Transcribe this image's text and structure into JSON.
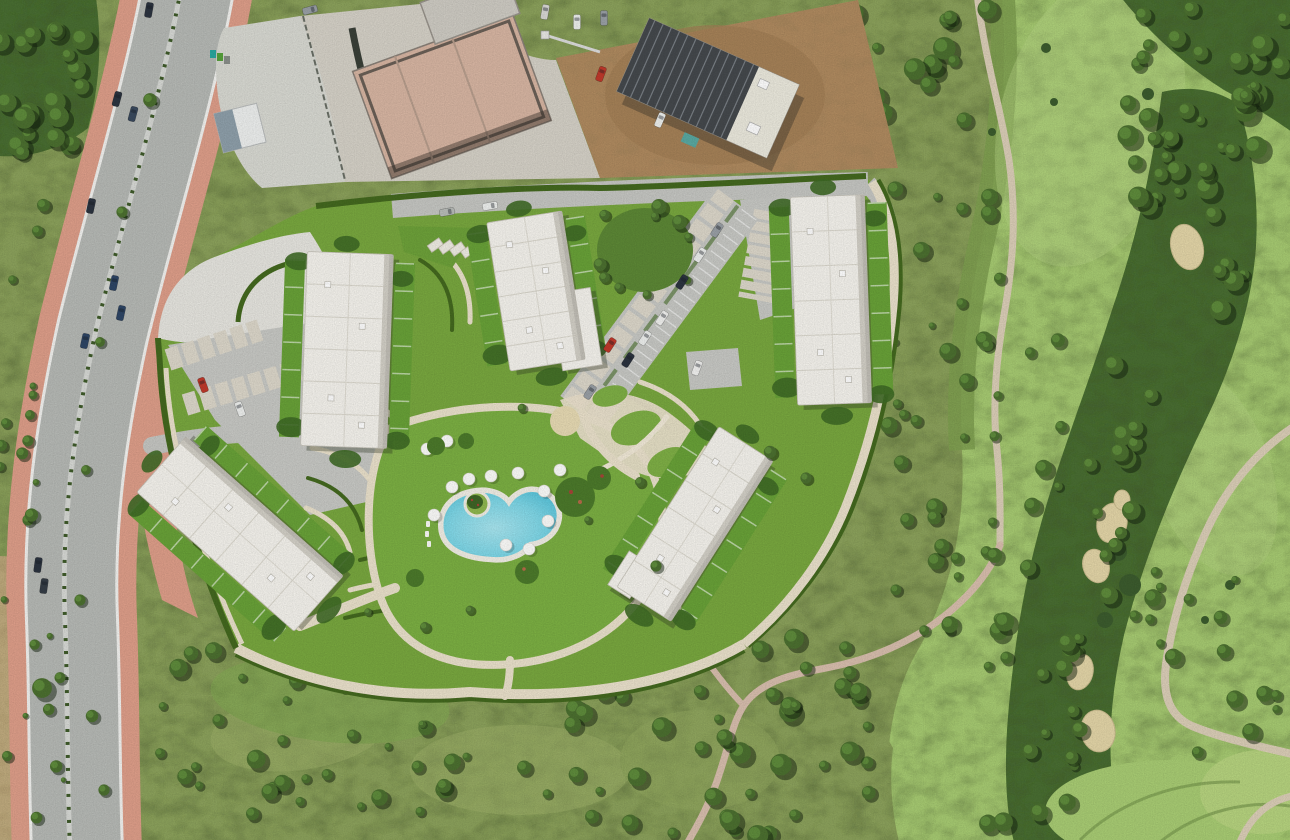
{
  "scene": {
    "description": "Aerial satellite view of a gated resort-style residential development with five white flat-roofed apartment buildings around landscaped gardens and a freeform swimming pool, bordered by a curved coastal avenue on the west, an active construction site to the north, and a golf course with fairways, tree lines and sand bunkers to the east",
    "features": [
      "curved-avenue-with-pink-sidewalks",
      "construction-site",
      "five-apartment-buildings",
      "swimming-pool-with-parasols",
      "terraced-hedge-gardens",
      "carport-parking",
      "golf-fairway",
      "sand-bunkers",
      "cart-paths",
      "scrubland"
    ]
  },
  "palette": {
    "scrub": "#8ca25c",
    "dry_scrub": "#c0ab7e",
    "fairway": "#a7cb72",
    "rough": "#7fa050",
    "trees": "#4a6e33",
    "lawn": "#79a83f",
    "pool_lawn": "#7cb043",
    "hedge": "#44691f",
    "asphalt": "#b7bab6",
    "sidewalk": "#df9f8a",
    "curb": "#f3f3f0",
    "gravel": "#d9dad3",
    "white_gravel": "#e7e6e0",
    "dirt": "#b08b60",
    "concrete_slab": "#d8b6a3",
    "dark_roof": "#45494d",
    "parking": "#c8c9c5",
    "carport": "#ddd8cb",
    "building": "#f6f4ee",
    "building_edge": "#cfccc2",
    "roof_line": "#dcd9cf",
    "path_cream": "#ebe2cc",
    "plaza_sand": "#e8dbb4",
    "pool_deck": "#f2efe6",
    "pool_water": "#6fd2e4",
    "bunker": "#e4d6a8",
    "cart_path": "#dccfb8",
    "trail": "#d9bfae",
    "shadow": "rgba(45,55,35,0.35)"
  },
  "buildings": [
    {
      "id": 1,
      "cx": 347,
      "cy": 350,
      "w": 86,
      "h": 194,
      "rot": 2
    },
    {
      "id": 2,
      "cx": 536,
      "cy": 291,
      "w": 76,
      "h": 150,
      "rot": -9,
      "annex": {
        "dx": 34,
        "dy": 44,
        "w": 40,
        "h": 78
      }
    },
    {
      "id": 3,
      "cx": 831,
      "cy": 300,
      "w": 74,
      "h": 208,
      "rot": -2
    },
    {
      "id": 4,
      "cx": 695,
      "cy": 524,
      "w": 64,
      "h": 190,
      "rot": 32.5,
      "annex": {
        "dx": -28,
        "dy": 78,
        "w": 26,
        "h": 40
      }
    },
    {
      "id": 5,
      "cx": 240,
      "cy": 534,
      "w": 74,
      "h": 210,
      "rot": -48.5
    }
  ],
  "parasols": [
    [
      452,
      487
    ],
    [
      469,
      479
    ],
    [
      491,
      476
    ],
    [
      518,
      473
    ],
    [
      544,
      491
    ],
    [
      548,
      521
    ],
    [
      434,
      515
    ],
    [
      506,
      545
    ],
    [
      529,
      549
    ],
    [
      427,
      449
    ],
    [
      447,
      441
    ],
    [
      560,
      470
    ]
  ],
  "flower_beds": [
    [
      575,
      497,
      20
    ],
    [
      599,
      478,
      12
    ],
    [
      527,
      572,
      12
    ],
    [
      436,
      446,
      9
    ],
    [
      466,
      441,
      8
    ],
    [
      415,
      578,
      9
    ]
  ],
  "cars": {
    "road": [
      {
        "x": 149,
        "y": 10,
        "a": 10,
        "c": "#2c3440"
      },
      {
        "x": 310,
        "y": 10,
        "a": 75,
        "c": "#9aa0a6"
      },
      {
        "x": 313,
        "y": 30,
        "a": 80,
        "c": "#eef0ee"
      },
      {
        "x": 117,
        "y": 99,
        "a": 15,
        "c": "#2c3440"
      },
      {
        "x": 133,
        "y": 114,
        "a": 15,
        "c": "#3a4a5e"
      },
      {
        "x": 91,
        "y": 206,
        "a": 12,
        "c": "#2c3440"
      },
      {
        "x": 114,
        "y": 283,
        "a": 12,
        "c": "#2e4666"
      },
      {
        "x": 121,
        "y": 313,
        "a": 12,
        "c": "#2e4666"
      },
      {
        "x": 85,
        "y": 341,
        "a": 12,
        "c": "#2e4666"
      },
      {
        "x": 38,
        "y": 565,
        "a": 8,
        "c": "#2c3440"
      },
      {
        "x": 44,
        "y": 586,
        "a": 8,
        "c": "#353d46"
      }
    ],
    "development": [
      {
        "x": 203,
        "y": 385,
        "a": -20,
        "c": "#c0392b"
      },
      {
        "x": 240,
        "y": 409,
        "a": -20,
        "c": "#eef0ee"
      },
      {
        "x": 610,
        "y": 345,
        "a": 33,
        "c": "#c0392b"
      },
      {
        "x": 645,
        "y": 338,
        "a": 33,
        "c": "#eef0ee"
      },
      {
        "x": 628,
        "y": 360,
        "a": 33,
        "c": "#2c3440"
      },
      {
        "x": 662,
        "y": 318,
        "a": 33,
        "c": "#f2f2f0"
      },
      {
        "x": 697,
        "y": 368,
        "a": 20,
        "c": "#f2f2f0"
      },
      {
        "x": 590,
        "y": 392,
        "a": 33,
        "c": "#9aa0a6"
      },
      {
        "x": 717,
        "y": 230,
        "a": 33,
        "c": "#9aa0a6"
      },
      {
        "x": 700,
        "y": 255,
        "a": 33,
        "c": "#eef0ee"
      },
      {
        "x": 682,
        "y": 282,
        "a": 33,
        "c": "#2c3440"
      },
      {
        "x": 447,
        "y": 212,
        "a": 80,
        "c": "#b9bdb9"
      },
      {
        "x": 490,
        "y": 206,
        "a": 80,
        "c": "#eef0ee"
      }
    ],
    "construction": [
      {
        "x": 601,
        "y": 74,
        "a": 20,
        "c": "#c0392b"
      },
      {
        "x": 577,
        "y": 22,
        "a": 0,
        "c": "#eef0ee"
      },
      {
        "x": 604,
        "y": 18,
        "a": 0,
        "c": "#9aa0a6"
      },
      {
        "x": 660,
        "y": 120,
        "a": 23,
        "c": "#eef0ee"
      },
      {
        "x": 545,
        "y": 12,
        "a": 10,
        "c": "#d8d8d4"
      }
    ]
  },
  "vegetation": {
    "tree_regions": [
      {
        "x": 160,
        "y": 640,
        "w": 470,
        "h": 190,
        "n": 55,
        "min": 0.6,
        "max": 1.6,
        "seed": 7,
        "layer": "low"
      },
      {
        "x": 630,
        "y": 636,
        "w": 240,
        "h": 200,
        "n": 26,
        "min": 0.7,
        "max": 1.8,
        "seed": 11,
        "layer": "low"
      },
      {
        "x": 882,
        "y": 175,
        "w": 118,
        "h": 460,
        "n": 38,
        "min": 0.5,
        "max": 1.4,
        "seed": 5,
        "layer": "low"
      },
      {
        "x": 0,
        "y": 0,
        "w": 102,
        "h": 162,
        "n": 20,
        "min": 0.8,
        "max": 1.8,
        "seed": 3,
        "layer": "low"
      },
      {
        "x": 0,
        "y": 168,
        "w": 52,
        "h": 390,
        "n": 12,
        "min": 0.5,
        "max": 1.1,
        "seed": 9,
        "layer": "low"
      },
      {
        "x": 853,
        "y": 0,
        "w": 140,
        "h": 122,
        "n": 15,
        "min": 0.8,
        "max": 1.9,
        "seed": 13,
        "layer": "low"
      },
      {
        "x": 1128,
        "y": 0,
        "w": 162,
        "h": 168,
        "n": 26,
        "min": 0.8,
        "max": 2.0,
        "seed": 19,
        "layer": "low"
      },
      {
        "x": 1138,
        "y": 84,
        "w": 118,
        "h": 250,
        "n": 22,
        "min": 0.8,
        "max": 1.8,
        "seed": 17,
        "layer": "low"
      },
      {
        "x": 1028,
        "y": 340,
        "w": 132,
        "h": 290,
        "n": 24,
        "min": 0.7,
        "max": 1.7,
        "seed": 21,
        "layer": "low"
      },
      {
        "x": 988,
        "y": 618,
        "w": 108,
        "h": 215,
        "n": 20,
        "min": 0.7,
        "max": 1.6,
        "seed": 23,
        "layer": "low"
      },
      {
        "x": 1150,
        "y": 560,
        "w": 140,
        "h": 200,
        "n": 14,
        "min": 0.6,
        "max": 1.4,
        "seed": 27,
        "layer": "low"
      },
      {
        "x": 700,
        "y": 640,
        "w": 170,
        "h": 110,
        "n": 13,
        "min": 0.6,
        "max": 1.5,
        "seed": 29,
        "layer": "low"
      },
      {
        "x": 4,
        "y": 560,
        "w": 60,
        "h": 270,
        "n": 10,
        "min": 0.4,
        "max": 1.0,
        "seed": 37,
        "layer": "low"
      },
      {
        "x": 600,
        "y": 206,
        "w": 92,
        "h": 92,
        "n": 10,
        "min": 0.6,
        "max": 1.3,
        "seed": 31,
        "layer": "high"
      }
    ],
    "street_trees": [
      [
        150,
        100,
        1.1
      ],
      [
        122,
        212,
        0.9
      ],
      [
        100,
        342,
        0.8
      ],
      [
        86,
        470,
        0.8
      ],
      [
        80,
        600,
        0.9
      ],
      [
        92,
        716,
        1.0
      ],
      [
        104,
        790,
        0.9
      ],
      [
        42,
        688,
        1.6
      ],
      [
        30,
        415,
        0.8
      ],
      [
        28,
        520,
        0.9
      ]
    ],
    "lawn_trees": [
      [
        770,
        452,
        1.0
      ],
      [
        806,
        478,
        0.9
      ],
      [
        656,
        566,
        0.9
      ],
      [
        425,
        627,
        0.8
      ],
      [
        522,
        408,
        0.7
      ],
      [
        640,
        482,
        0.8
      ],
      [
        588,
        520,
        0.6
      ],
      [
        470,
        610,
        0.7
      ],
      [
        368,
        612,
        0.6
      ]
    ]
  },
  "counts": {
    "apartment_buildings": 5,
    "construction_buildings": 2,
    "swimming_pools": 1,
    "sand_bunker_clusters": 3,
    "parasols": 12
  }
}
